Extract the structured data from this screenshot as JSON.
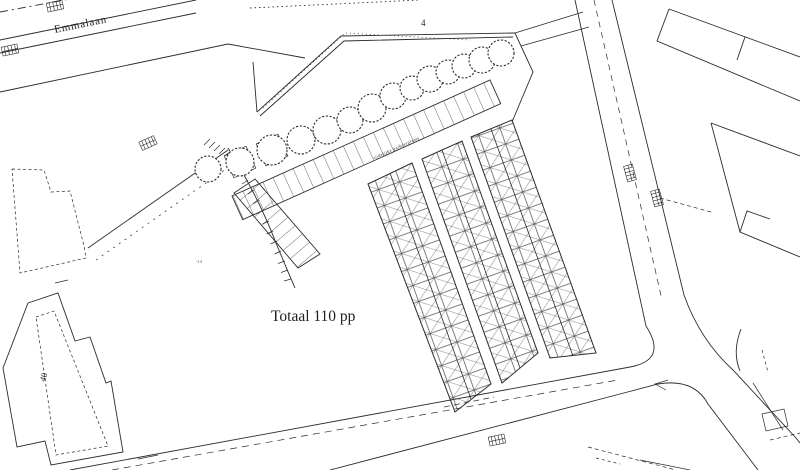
{
  "title": "Parking site plan",
  "labels": {
    "street": "Emmalaan",
    "building_top": "4",
    "building_bottom_left": "40",
    "total": "Totaal 110 pp",
    "aisle": "tijdelijke parkeerplaats",
    "elevation": "-1.4"
  },
  "parking": {
    "total_spaces": 110,
    "tree_count": 14,
    "double_row_count": 3
  },
  "colors": {
    "background": "#ffffff",
    "line": "#2b2b2b",
    "text": "#1f1f1f"
  }
}
